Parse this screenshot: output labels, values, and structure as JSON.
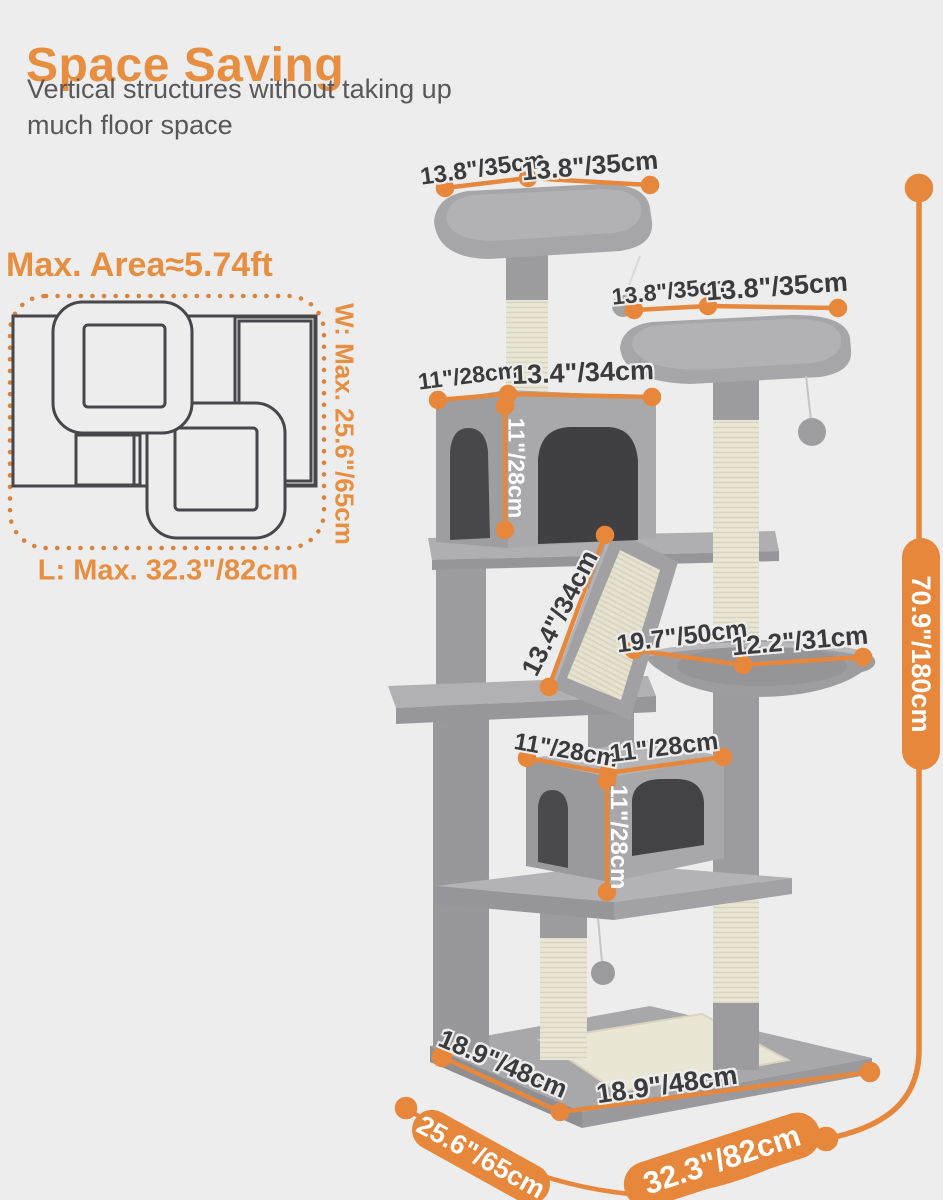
{
  "colors": {
    "background": "#EDEDED",
    "accent": "#E6873C",
    "title": "#E78E40",
    "subtitle": "#58585A",
    "dimension_text": "#3B3B3D",
    "tree_gray": "#A6A6A9",
    "sisal": "#EAE6D6"
  },
  "header": {
    "title": "Space Saving",
    "subtitle_line1": "Vertical structures without taking up",
    "subtitle_line2": "much floor space"
  },
  "floorplan": {
    "title": "Max. Area≈5.74ft",
    "width_label": "W: Max. 25.6\"/65cm",
    "length_label": "L: Max. 32.3\"/82cm"
  },
  "dimensions": {
    "top_perch_left": "13.8\"/35cm",
    "top_perch_right": "13.8\"/35cm",
    "second_perch_left": "13.8\"/35cm",
    "second_perch_right": "13.8\"/35cm",
    "upper_condo_width": "11\"/28cm",
    "upper_condo_depth": "13.4\"/34cm",
    "upper_condo_height": "11\"/28cm",
    "ramp_length": "13.4\"/34cm",
    "hammock_length": "19.7\"/50cm",
    "hammock_width": "12.2\"/31cm",
    "lower_condo_width": "11\"/28cm",
    "lower_condo_depth": "11\"/28cm",
    "lower_condo_height": "11\"/28cm",
    "base_left": "18.9\"/48cm",
    "base_right": "18.9\"/48cm",
    "total_height": "70.9\"/180cm",
    "floor_depth": "25.6\"/65cm",
    "floor_width": "32.3\"/82cm"
  }
}
